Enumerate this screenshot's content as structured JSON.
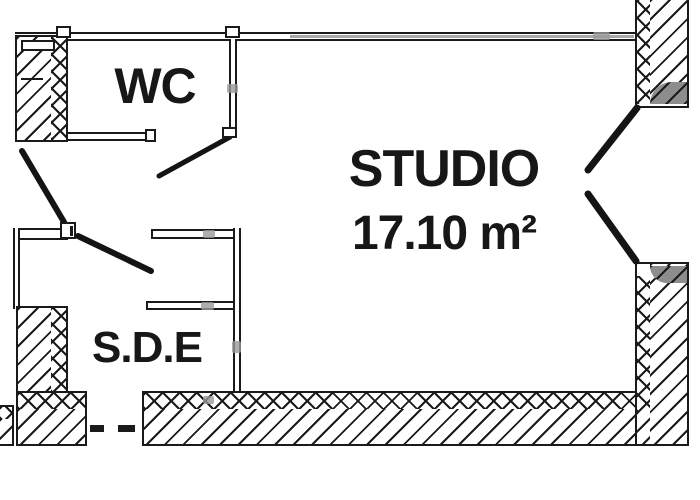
{
  "rooms": {
    "wc": {
      "label": "WC"
    },
    "studio": {
      "label": "STUDIO",
      "area": "17.10 m²"
    },
    "sde": {
      "label": "S.D.E"
    }
  },
  "colors": {
    "ink": "#1a1a1a",
    "paper": "#ffffff",
    "wall_shade_gray": "#8d8d8d",
    "scan_artifact_gray": "#9a9a9a"
  }
}
